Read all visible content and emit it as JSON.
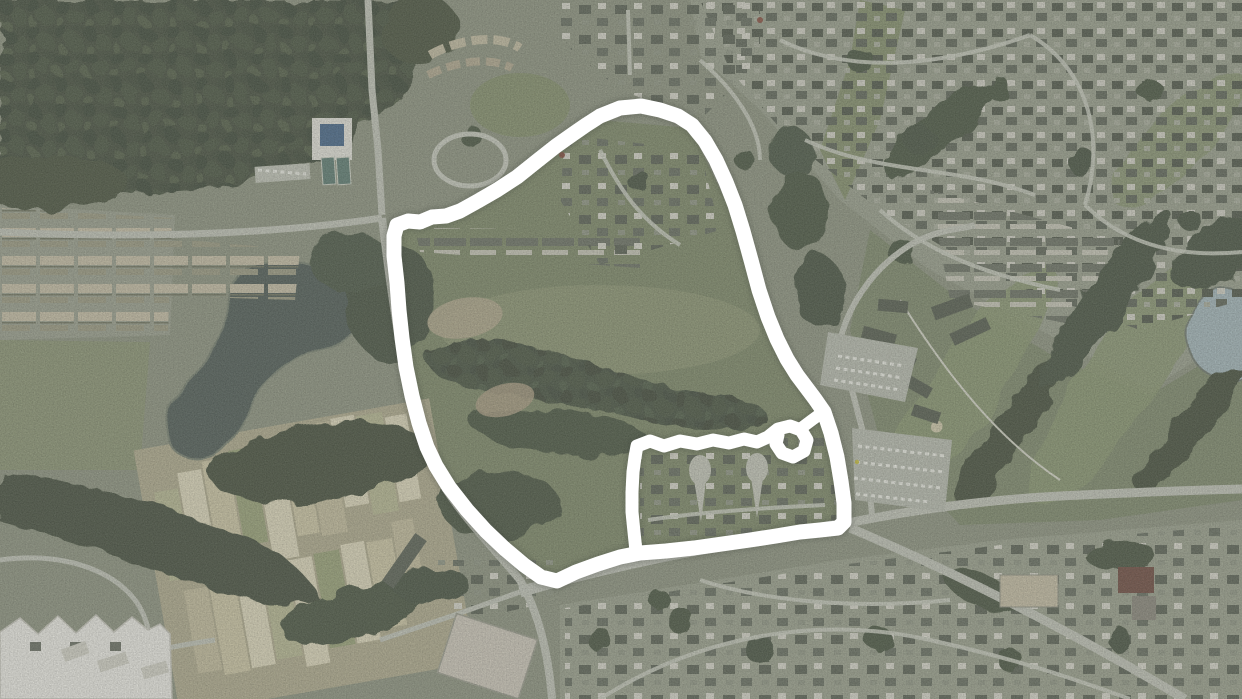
{
  "window": {
    "width": 1242,
    "height": 699,
    "title": ""
  },
  "map": {
    "kind": "aerial-satellite-photo",
    "visible_features": [
      "dense-forest-top-left",
      "lake-left",
      "small-pond-right-edge",
      "community-garden-plots-bottom-left",
      "golf-fairways-right",
      "residential-subdivisions",
      "townhouse-clusters",
      "parking-lots-center-right",
      "large-white-building-bottom-left",
      "warehouse-bottom-center",
      "red-roof-building-bottom-right",
      "road-network"
    ],
    "annotation": {
      "shape": "hand-drawn-parcel-outline-with-inner-cutout",
      "color": "#ffffff",
      "stroke_width": 15,
      "outer_boundary_points": [
        [
          600,
          116
        ],
        [
          620,
          108
        ],
        [
          641,
          106
        ],
        [
          660,
          110
        ],
        [
          678,
          116
        ],
        [
          692,
          125
        ],
        [
          705,
          141
        ],
        [
          716,
          160
        ],
        [
          726,
          182
        ],
        [
          735,
          205
        ],
        [
          743,
          231
        ],
        [
          751,
          260
        ],
        [
          759,
          290
        ],
        [
          768,
          317
        ],
        [
          777,
          339
        ],
        [
          787,
          359
        ],
        [
          797,
          375
        ],
        [
          806,
          387
        ],
        [
          815,
          399
        ],
        [
          824,
          412
        ],
        [
          831,
          433
        ],
        [
          837,
          457
        ],
        [
          841,
          481
        ],
        [
          844,
          503
        ],
        [
          844,
          522
        ],
        [
          838,
          528
        ],
        [
          820,
          530
        ],
        [
          800,
          532
        ],
        [
          776,
          536
        ],
        [
          750,
          540
        ],
        [
          722,
          544
        ],
        [
          694,
          548
        ],
        [
          666,
          551
        ],
        [
          640,
          553
        ],
        [
          620,
          557
        ],
        [
          598,
          564
        ],
        [
          576,
          572
        ],
        [
          557,
          581
        ],
        [
          541,
          577
        ],
        [
          524,
          565
        ],
        [
          505,
          549
        ],
        [
          486,
          531
        ],
        [
          467,
          510
        ],
        [
          449,
          487
        ],
        [
          436,
          466
        ],
        [
          427,
          447
        ],
        [
          419,
          423
        ],
        [
          412,
          396
        ],
        [
          406,
          367
        ],
        [
          402,
          338
        ],
        [
          399,
          310
        ],
        [
          397,
          283
        ],
        [
          394,
          256
        ],
        [
          394,
          236
        ],
        [
          397,
          225
        ],
        [
          408,
          221
        ],
        [
          420,
          222
        ],
        [
          432,
          217
        ],
        [
          446,
          216
        ],
        [
          460,
          211
        ],
        [
          478,
          201
        ],
        [
          497,
          190
        ],
        [
          517,
          177
        ],
        [
          537,
          161
        ],
        [
          556,
          146
        ],
        [
          573,
          134
        ],
        [
          586,
          125
        ]
      ],
      "inner_cutout_points": [
        [
          636,
          551
        ],
        [
          634,
          532
        ],
        [
          632,
          512
        ],
        [
          632,
          492
        ],
        [
          633,
          472
        ],
        [
          635,
          457
        ],
        [
          637,
          446
        ],
        [
          650,
          441
        ],
        [
          664,
          446
        ],
        [
          680,
          441
        ],
        [
          697,
          444
        ],
        [
          713,
          440
        ],
        [
          729,
          443
        ],
        [
          744,
          439
        ],
        [
          757,
          442
        ],
        [
          768,
          437
        ],
        [
          778,
          429
        ],
        [
          790,
          426
        ],
        [
          801,
          430
        ],
        [
          807,
          440
        ],
        [
          804,
          451
        ],
        [
          793,
          457
        ],
        [
          782,
          453
        ],
        [
          776,
          444
        ],
        [
          778,
          435
        ]
      ],
      "cutout_connector_points": [
        [
          800,
          429
        ],
        [
          812,
          420
        ],
        [
          823,
          412
        ]
      ]
    },
    "palette": {
      "forest": "#46523f",
      "meadow": "#7d8967",
      "residential_ground": "#99a08c",
      "road": "#c2c6b8",
      "water_lake": "#4f5c54",
      "water_pond": "#a3b7ba",
      "field_tan": "#cdc7a4",
      "building_light": "#efefe7",
      "building_dark": "#565e4f",
      "annotation": "#ffffff"
    }
  }
}
